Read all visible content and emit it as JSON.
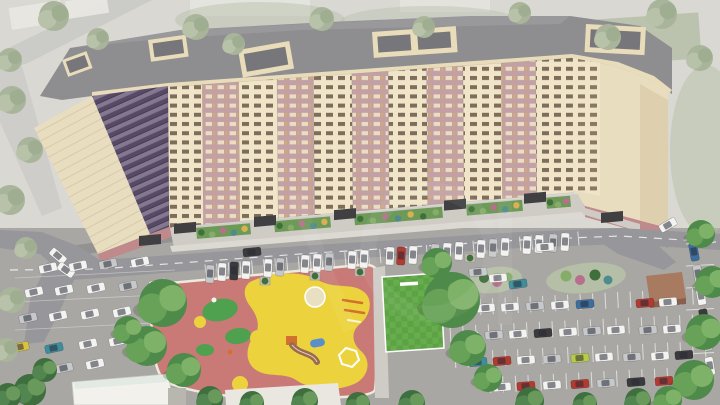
{
  "scene": {
    "type": "3d-architectural-render",
    "subject": "aerial view of curved multi-section residential apartment block with courtyard, playground, sports lawn and parking lots",
    "storeys_visible": 17,
    "entrances_visible": 7,
    "roof_structures": 5,
    "watermark_present": true,
    "watermark_opacity": 0.05
  },
  "palette": {
    "backdrop": "#d9d8d3",
    "backdrop_street": "#cbcbc7",
    "backdrop_block": "#e9e8e3",
    "backdrop_green": "#b5bfa7",
    "roof": "#8e8d90",
    "roof_dark": "#77767a",
    "roof_light": "#a2a1a5",
    "parapet": "#e8dcba",
    "facade_cream": "#f0e5c9",
    "facade_mauve": "#c2a0a4",
    "window_dark": "#6a5847",
    "window_cream": "#efe4c8",
    "window_lit": "#d9b054",
    "glass_dark": "#584a66",
    "glass_light": "#93879f",
    "end_wall": "#e9ddc0",
    "end_wall_shade": "#d8c9a6",
    "plinth_pink": "#c08a8c",
    "canopy": "#404043",
    "paving": "#cfccc6",
    "sidewalk": "#dcd9d3",
    "road": "#97969a",
    "parking": "#a9a7a3",
    "stall_line": "#eceae6",
    "greenery": "#6e9a58",
    "shrub_dark": "#3f6f3a",
    "shrub_light": "#86ac69",
    "shrub_pink": "#b86f8e",
    "shrub_teal": "#4e8b8d",
    "playground_base": "#c97a76",
    "playground_yellow": "#ecd33e",
    "playground_green": "#4fa04f",
    "curb": "#eceadf",
    "sand": "#e9dfc2",
    "field_green": "#66ad4b",
    "field_green_dark": "#5da246",
    "equip_orange": "#d2702e",
    "equip_brown": "#9a6b4f",
    "equip_blue": "#5b8fc9",
    "kiosk_brown": "#8a5f4d",
    "kiosk_roof": "#a87a5f",
    "white_building": "#f2f1ec",
    "white_building_tint": "#dfe8e2",
    "shadow": "rgba(55,55,68,0.18)",
    "watermark": "#ffffff"
  },
  "car_colors": {
    "w": "#f3f3f1",
    "s": "#c6c8ca",
    "r": "#b13a31",
    "b": "#3c6e9e",
    "t": "#3e8d9c",
    "y": "#d9c23f",
    "l": "#b9c94a",
    "d": "#3b3b3d"
  },
  "facade_bands": [
    "cream",
    "mauve",
    "cream",
    "mauve",
    "cream",
    "mauve",
    "cream",
    "mauve",
    "cream",
    "mauve",
    "cream"
  ],
  "facade_band_widths": [
    0.085,
    0.09,
    0.095,
    0.09,
    0.095,
    0.09,
    0.095,
    0.09,
    0.095,
    0.085,
    0.09
  ],
  "entrances": [
    [
      150,
      238
    ],
    [
      185,
      null
    ],
    [
      265,
      null
    ],
    [
      345,
      null
    ],
    [
      455,
      null
    ],
    [
      535,
      null
    ],
    [
      612,
      215
    ]
  ],
  "garden_beds": [
    [
      196,
      250
    ],
    [
      274,
      330
    ],
    [
      354,
      442
    ],
    [
      466,
      522
    ],
    [
      546,
      570
    ]
  ],
  "planters": [
    [
      265,
      281
    ],
    [
      315,
      276
    ],
    [
      360,
      272
    ],
    [
      470,
      258
    ]
  ],
  "cars": [
    [
      210,
      274,
      93,
      "s"
    ],
    [
      222,
      272,
      93,
      "w"
    ],
    [
      234,
      271,
      93,
      "d"
    ],
    [
      246,
      270,
      93,
      "w"
    ],
    [
      268,
      268,
      93,
      "w"
    ],
    [
      280,
      267,
      93,
      "s"
    ],
    [
      305,
      264,
      93,
      "w"
    ],
    [
      317,
      263,
      93,
      "w"
    ],
    [
      329,
      262,
      93,
      "s"
    ],
    [
      352,
      260,
      93,
      "w"
    ],
    [
      364,
      259,
      93,
      "w"
    ],
    [
      390,
      256,
      93,
      "w"
    ],
    [
      401,
      256,
      93,
      "r"
    ],
    [
      413,
      255,
      93,
      "w"
    ],
    [
      435,
      253,
      93,
      "s"
    ],
    [
      447,
      252,
      93,
      "w"
    ],
    [
      459,
      251,
      93,
      "w"
    ],
    [
      481,
      249,
      93,
      "w"
    ],
    [
      493,
      248,
      93,
      "s"
    ],
    [
      505,
      247,
      93,
      "w"
    ],
    [
      527,
      245,
      93,
      "w"
    ],
    [
      539,
      244,
      93,
      "w"
    ],
    [
      553,
      243,
      93,
      "s"
    ],
    [
      565,
      242,
      93,
      "w"
    ],
    [
      58,
      256,
      40,
      "w"
    ],
    [
      66,
      270,
      35,
      "w"
    ],
    [
      252,
      252,
      -6,
      "d"
    ],
    [
      545,
      247,
      -4,
      "w"
    ],
    [
      668,
      225,
      -30,
      "w"
    ],
    [
      48,
      268,
      -12,
      "w"
    ],
    [
      78,
      266,
      -12,
      "w"
    ],
    [
      108,
      264,
      -12,
      "s"
    ],
    [
      140,
      262,
      -12,
      "w"
    ],
    [
      34,
      292,
      -12,
      "w"
    ],
    [
      64,
      290,
      -12,
      "w"
    ],
    [
      96,
      288,
      -12,
      "w"
    ],
    [
      128,
      286,
      -12,
      "s"
    ],
    [
      158,
      284,
      -12,
      "w"
    ],
    [
      28,
      318,
      -12,
      "s"
    ],
    [
      58,
      316,
      -12,
      "w"
    ],
    [
      90,
      314,
      -12,
      "w"
    ],
    [
      122,
      312,
      -12,
      "w"
    ],
    [
      20,
      347,
      -12,
      "y"
    ],
    [
      54,
      348,
      -12,
      "t"
    ],
    [
      88,
      344,
      -12,
      "w"
    ],
    [
      118,
      341,
      -12,
      "w"
    ],
    [
      64,
      368,
      -12,
      "s"
    ],
    [
      95,
      364,
      -12,
      "w"
    ],
    [
      478,
      272,
      -5,
      "s"
    ],
    [
      498,
      278,
      -5,
      "w"
    ],
    [
      518,
      284,
      -8,
      "t"
    ],
    [
      462,
      309,
      -5,
      "w"
    ],
    [
      486,
      308,
      -5,
      "w"
    ],
    [
      510,
      307,
      -5,
      "w"
    ],
    [
      535,
      306,
      -5,
      "s"
    ],
    [
      560,
      305,
      -5,
      "w"
    ],
    [
      585,
      304,
      -5,
      "b"
    ],
    [
      645,
      303,
      -5,
      "r"
    ],
    [
      668,
      302,
      -5,
      "w"
    ],
    [
      470,
      336,
      -5,
      "w"
    ],
    [
      494,
      335,
      -5,
      "s"
    ],
    [
      518,
      334,
      -5,
      "w"
    ],
    [
      543,
      333,
      -5,
      "d"
    ],
    [
      568,
      332,
      -5,
      "w"
    ],
    [
      592,
      331,
      -5,
      "s"
    ],
    [
      616,
      330,
      -5,
      "w"
    ],
    [
      648,
      330,
      -5,
      "s"
    ],
    [
      672,
      329,
      -5,
      "w"
    ],
    [
      478,
      362,
      -5,
      "t"
    ],
    [
      502,
      361,
      -5,
      "r"
    ],
    [
      526,
      360,
      -5,
      "w"
    ],
    [
      552,
      359,
      -5,
      "s"
    ],
    [
      580,
      358,
      -5,
      "l"
    ],
    [
      604,
      357,
      -5,
      "w"
    ],
    [
      632,
      357,
      -5,
      "s"
    ],
    [
      660,
      356,
      -5,
      "w"
    ],
    [
      684,
      355,
      -5,
      "d"
    ],
    [
      502,
      387,
      -5,
      "w"
    ],
    [
      526,
      386,
      -5,
      "r"
    ],
    [
      552,
      385,
      -5,
      "w"
    ],
    [
      580,
      384,
      -5,
      "r"
    ],
    [
      606,
      383,
      -5,
      "s"
    ],
    [
      636,
      382,
      -5,
      "d"
    ],
    [
      664,
      381,
      -5,
      "r"
    ],
    [
      690,
      380,
      -5,
      "w"
    ],
    [
      694,
      252,
      80,
      "b"
    ],
    [
      698,
      274,
      80,
      "s"
    ],
    [
      701,
      296,
      80,
      "w"
    ],
    [
      704,
      318,
      80,
      "d"
    ],
    [
      707,
      342,
      80,
      "s"
    ],
    [
      710,
      366,
      80,
      "w"
    ]
  ],
  "trees": [
    [
      163,
      303,
      24,
      "v"
    ],
    [
      147,
      346,
      20,
      "v"
    ],
    [
      184,
      370,
      17,
      "v"
    ],
    [
      128,
      330,
      14,
      "v"
    ],
    [
      452,
      300,
      28,
      "v"
    ],
    [
      437,
      263,
      15,
      "v"
    ],
    [
      468,
      348,
      18,
      "v"
    ],
    [
      488,
      378,
      14,
      "v"
    ],
    [
      701,
      234,
      14,
      "v"
    ],
    [
      712,
      282,
      16,
      "v"
    ],
    [
      704,
      332,
      18,
      "v"
    ],
    [
      694,
      380,
      20,
      "v"
    ],
    [
      668,
      400,
      14,
      "v"
    ],
    [
      210,
      399,
      13,
      "d"
    ],
    [
      252,
      403,
      12,
      "d"
    ],
    [
      305,
      401,
      13,
      "d"
    ],
    [
      358,
      404,
      12,
      "d"
    ],
    [
      412,
      403,
      13,
      "d"
    ],
    [
      530,
      401,
      14,
      "d"
    ],
    [
      585,
      404,
      12,
      "d"
    ],
    [
      638,
      401,
      13,
      "d"
    ],
    [
      30,
      390,
      16,
      "d"
    ],
    [
      8,
      396,
      13,
      "d"
    ],
    [
      45,
      370,
      12,
      "d"
    ],
    [
      196,
      27,
      13,
      "m"
    ],
    [
      234,
      44,
      11,
      "m"
    ],
    [
      322,
      19,
      12,
      "m"
    ],
    [
      424,
      27,
      11,
      "m"
    ],
    [
      520,
      13,
      11,
      "m"
    ],
    [
      608,
      37,
      13,
      "m"
    ],
    [
      662,
      14,
      15,
      "m"
    ],
    [
      700,
      58,
      13,
      "m"
    ],
    [
      54,
      16,
      15,
      "m"
    ],
    [
      98,
      39,
      11,
      "m"
    ],
    [
      10,
      60,
      12,
      "m"
    ],
    [
      12,
      100,
      14,
      "m"
    ],
    [
      30,
      150,
      13,
      "m"
    ],
    [
      10,
      200,
      15,
      "m"
    ],
    [
      26,
      248,
      11,
      "m"
    ],
    [
      12,
      300,
      13,
      "m"
    ],
    [
      6,
      350,
      12,
      "m"
    ]
  ],
  "tree_tones": {
    "v": [
      "#4e8a49",
      "#68a258",
      "#7fb269"
    ],
    "m": [
      "#a9b59a",
      "#b8c2a8",
      "#9fae90"
    ],
    "d": [
      "#3f6f3f",
      "#538551",
      "#699a5c"
    ]
  }
}
